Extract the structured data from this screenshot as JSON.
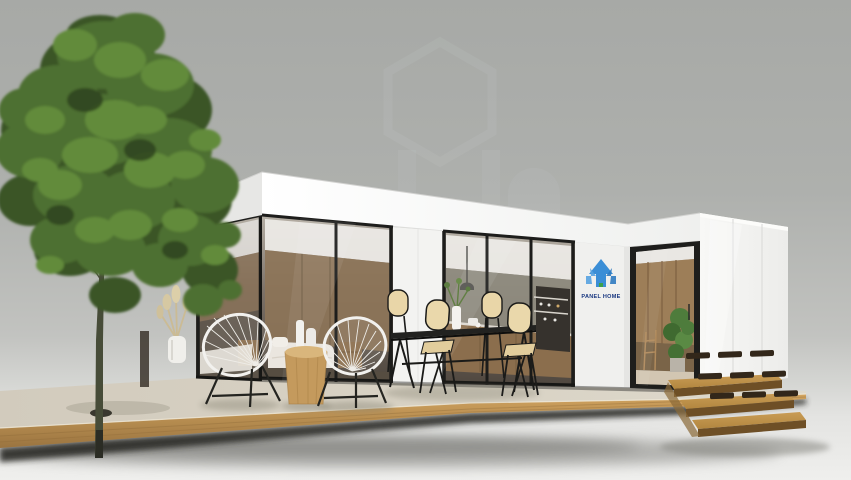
{
  "branding": {
    "logo_text": "PANEL HOME"
  },
  "palette": {
    "background_wall": "#a9aba8",
    "background_floor": "#efefed",
    "building_white": "#f6f6f4",
    "frame_black": "#1d1d1b",
    "deck_surface": "#d6cfc1",
    "deck_wood": "#bb8f4d",
    "foliage_green": "#4d7030",
    "logo_blue": "#3b8ed6",
    "logo_green": "#3da14b",
    "logo_text_color": "#16357f",
    "chair_beige": "#e9d6a8"
  }
}
